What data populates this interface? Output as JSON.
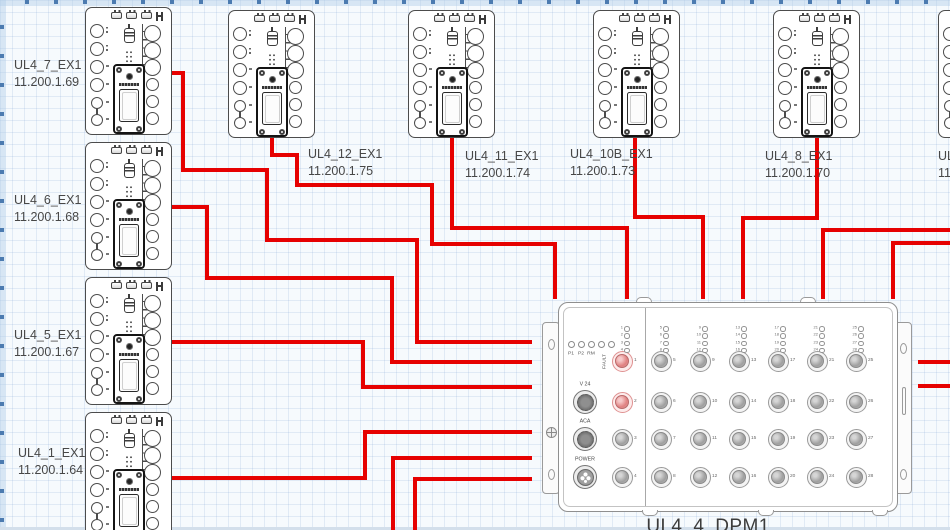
{
  "canvas": {
    "width": 950,
    "height": 530,
    "background": "#f6fafd",
    "grid_color": "#6e96c8",
    "wire_color": "#e60101",
    "edge_strip_color": "#d3dfeb"
  },
  "modules": [
    {
      "name": "UL4_7_EX1",
      "ip": "11.200.1.69",
      "x": 85,
      "y": 7,
      "label_x": 14,
      "label_y": 57
    },
    {
      "name": "UL4_6_EX1",
      "ip": "11.200.1.68",
      "x": 85,
      "y": 142,
      "label_x": 14,
      "label_y": 192
    },
    {
      "name": "UL4_5_EX1",
      "ip": "11.200.1.67",
      "x": 85,
      "y": 277,
      "label_x": 14,
      "label_y": 327
    },
    {
      "name": "UL4_1_EX1",
      "ip": "11.200.1.64",
      "x": 85,
      "y": 412,
      "label_x": 18,
      "label_y": 445
    },
    {
      "name": "UL4_12_EX1",
      "ip": "11.200.1.75",
      "x": 228,
      "y": 10,
      "label_x": 308,
      "label_y": 146
    },
    {
      "name": "UL4_11_EX1",
      "ip": "11.200.1.74",
      "x": 408,
      "y": 10,
      "label_x": 465,
      "label_y": 148
    },
    {
      "name": "UL4_10B_EX1",
      "ip": "11.200.1.73",
      "x": 593,
      "y": 10,
      "label_x": 570,
      "label_y": 146
    },
    {
      "name": "UL4_8_EX1",
      "ip": "11.200.1.70",
      "x": 773,
      "y": 10,
      "label_x": 765,
      "label_y": 148
    },
    {
      "name": "UL",
      "ip": "11",
      "x": 938,
      "y": 10,
      "label_x": 938,
      "label_y": 148,
      "partial": true
    }
  ],
  "dpm": {
    "title": "UL4_4_DPM1",
    "x": 558,
    "y": 302,
    "width": 340,
    "height": 210,
    "status_led_labels": [
      "P1",
      "P2",
      "RM",
      "FAULT"
    ],
    "aux_ports": [
      "V 24",
      "ACA",
      "POWER"
    ],
    "port_columns": [
      [
        1,
        2,
        3,
        4
      ],
      [
        5,
        6,
        7,
        8
      ],
      [
        9,
        10,
        11,
        12
      ],
      [
        13,
        14,
        15,
        16
      ],
      [
        17,
        18,
        19,
        20
      ],
      [
        21,
        22,
        23,
        24
      ],
      [
        25,
        26,
        27,
        28
      ]
    ],
    "highlighted_ports": [
      1,
      2
    ]
  },
  "wires": [
    {
      "from": "UL4_7_EX1",
      "to": "UL4_4_DPM1",
      "points": [
        [
          172,
          73
        ],
        [
          183,
          73
        ],
        [
          183,
          170
        ],
        [
          267,
          170
        ],
        [
          267,
          240
        ],
        [
          417,
          240
        ],
        [
          417,
          342
        ],
        [
          532,
          342
        ]
      ]
    },
    {
      "from": "UL4_6_EX1",
      "to": "UL4_4_DPM1",
      "points": [
        [
          172,
          207
        ],
        [
          207,
          207
        ],
        [
          207,
          278
        ],
        [
          392,
          278
        ],
        [
          392,
          362
        ],
        [
          532,
          362
        ]
      ]
    },
    {
      "from": "UL4_5_EX1",
      "to": "UL4_4_DPM1",
      "points": [
        [
          172,
          342
        ],
        [
          363,
          342
        ],
        [
          363,
          387
        ],
        [
          532,
          387
        ]
      ]
    },
    {
      "from": "UL4_1_EX1",
      "to": "UL4_4_DPM1",
      "points": [
        [
          172,
          478
        ],
        [
          365,
          478
        ],
        [
          365,
          432
        ],
        [
          532,
          432
        ]
      ]
    },
    {
      "from": "UL4_12_EX1",
      "to": "UL4_4_DPM1",
      "points": [
        [
          272,
          136
        ],
        [
          272,
          155
        ],
        [
          297,
          155
        ],
        [
          297,
          185
        ],
        [
          432,
          185
        ],
        [
          432,
          244
        ],
        [
          555,
          244
        ],
        [
          555,
          299
        ]
      ]
    },
    {
      "from": "UL4_11_EX1",
      "to": "UL4_4_DPM1",
      "points": [
        [
          452,
          136
        ],
        [
          452,
          228
        ],
        [
          627,
          228
        ],
        [
          627,
          299
        ]
      ]
    },
    {
      "from": "UL4_10B_EX1",
      "to": "UL4_4_DPM1",
      "points": [
        [
          635,
          136
        ],
        [
          635,
          217
        ],
        [
          703,
          217
        ],
        [
          703,
          299
        ]
      ]
    },
    {
      "from": "UL4_8_EX1",
      "to": "UL4_4_DPM1",
      "points": [
        [
          817,
          136
        ],
        [
          817,
          218
        ],
        [
          743,
          218
        ],
        [
          743,
          299
        ]
      ]
    },
    {
      "to": "UL4_4_DPM1",
      "points": [
        [
          950,
          230
        ],
        [
          823,
          230
        ],
        [
          823,
          299
        ]
      ]
    },
    {
      "to": "UL4_4_DPM1",
      "points": [
        [
          950,
          243
        ],
        [
          893,
          243
        ],
        [
          893,
          299
        ]
      ]
    },
    {
      "points": [
        [
          950,
          362
        ],
        [
          918,
          362
        ]
      ]
    },
    {
      "points": [
        [
          950,
          386
        ],
        [
          918,
          386
        ]
      ]
    },
    {
      "to": "UL4_4_DPM1",
      "points": [
        [
          393,
          530
        ],
        [
          393,
          458
        ],
        [
          532,
          458
        ]
      ]
    },
    {
      "to": "UL4_4_DPM1",
      "points": [
        [
          415,
          530
        ],
        [
          415,
          479
        ],
        [
          532,
          479
        ]
      ]
    }
  ]
}
